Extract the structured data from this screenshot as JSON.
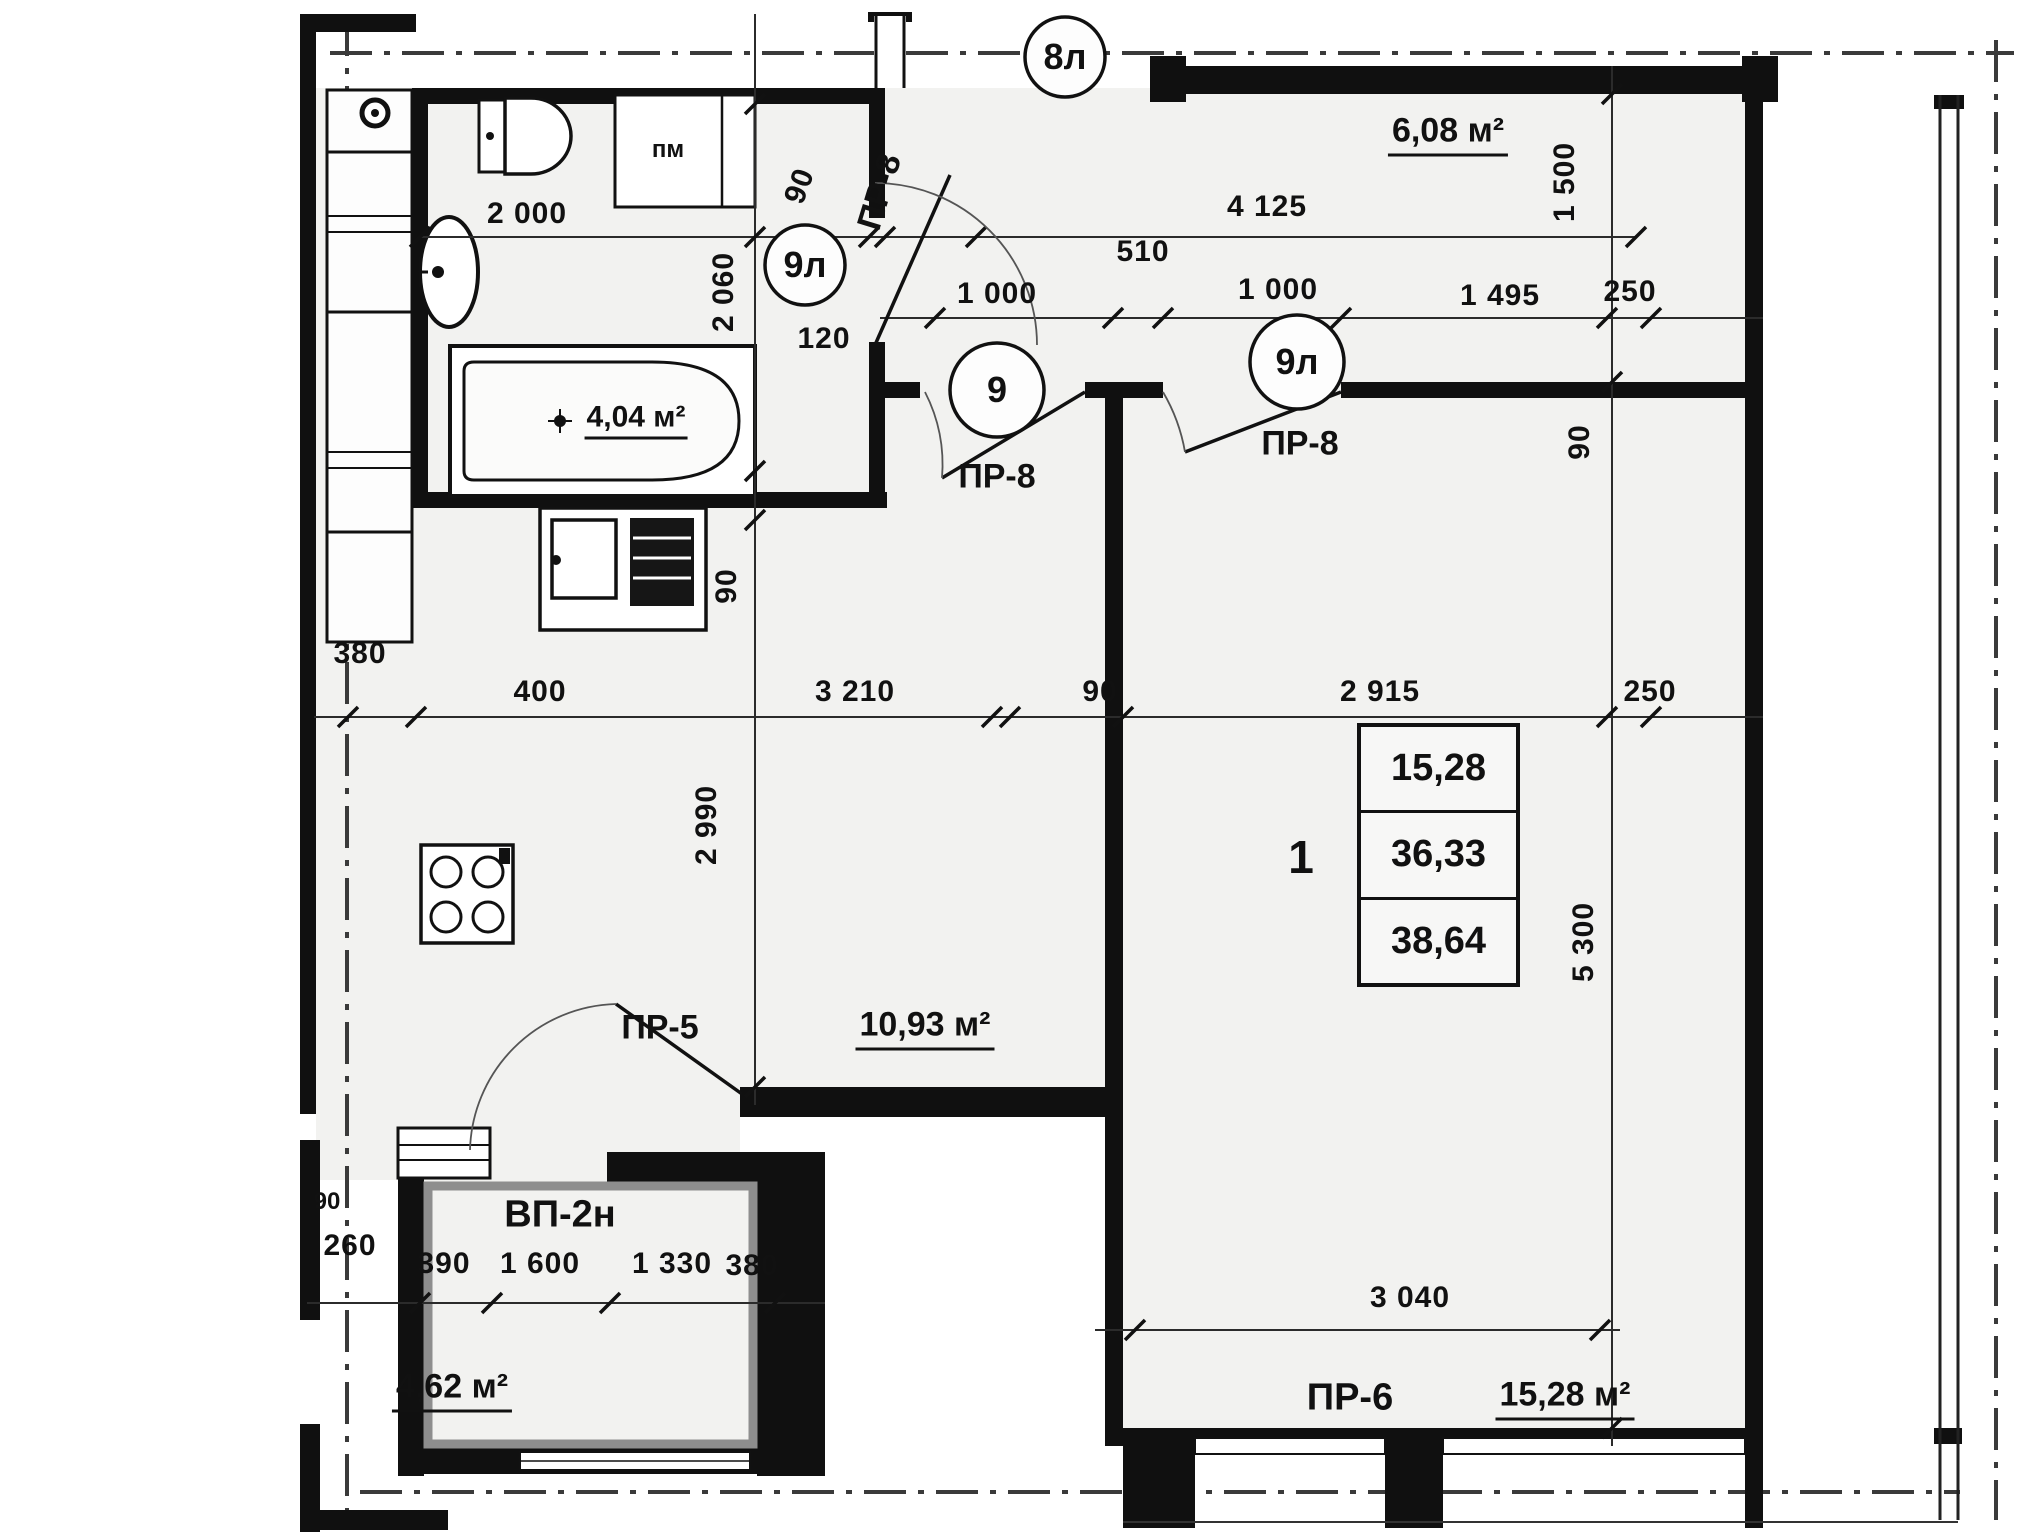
{
  "axis_circles": {
    "a8l": "8л",
    "a9l_bath": "9л",
    "a9": "9",
    "a9l_room": "9л"
  },
  "labels": {
    "pm": "пм",
    "pr8_vertical": "ПР-8",
    "pr8_hall": "ПР-8",
    "pr8_room": "ПР-8",
    "pr5": "ПР-5",
    "pr6": "ПР-6",
    "vp2n": "ВП-2н"
  },
  "areas": {
    "bathroom": "4,04 м²",
    "top_right": "6,08 м²",
    "hall": "10,93 м²",
    "bottom_left": "4,62 м²",
    "living": "15,28 м²"
  },
  "dimensions": {
    "d2000": "2 000",
    "d90_top": "90",
    "d4125": "4 125",
    "d510": "510",
    "d1000_a": "1 000",
    "d1000_b": "1 000",
    "d1495": "1 495",
    "d250_a": "250",
    "d1500": "1 500",
    "d2060": "2 060",
    "d120": "120",
    "d90_right": "90",
    "d90_sink": "90",
    "d380_left": "380",
    "d400": "400",
    "d3210": "3 210",
    "d90_mid": "90",
    "d2915": "2 915",
    "d250_b": "250",
    "d2990": "2 990",
    "d5300": "5 300",
    "d390": "390",
    "d1600": "1 600",
    "d1330": "1 330",
    "d380_b": "380",
    "d90_bl": "90",
    "d260": "260",
    "d3040": "3 040"
  },
  "apartment_table": {
    "number": "1",
    "rows": [
      "15,28",
      "36,33",
      "38,64"
    ]
  }
}
